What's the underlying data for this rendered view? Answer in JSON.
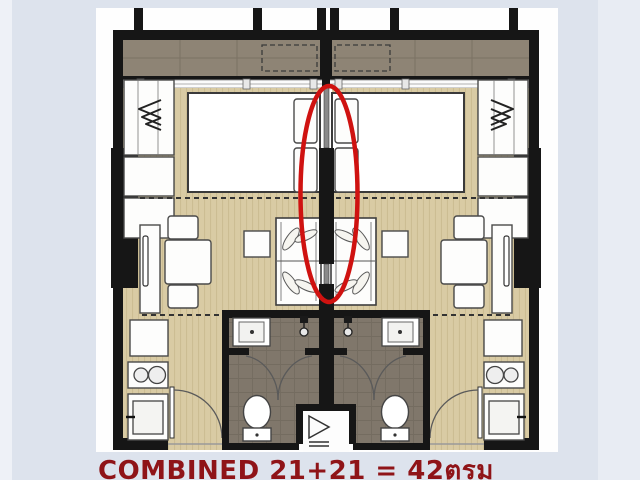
{
  "page": {
    "type": "real-estate floor plan photo",
    "width": 640,
    "height": 480
  },
  "caption": {
    "text": "COMBINED 21+21 = 42ตรม",
    "label": "COMBINED",
    "area_left": "21",
    "area_right": "21",
    "area_total": "42",
    "area_unit": "ตรม"
  },
  "annotation": {
    "shape": "red-ellipse",
    "highlights": "central shared wall between the two mirrored units"
  },
  "floor_plan": {
    "layout": "two mirrored studio units sharing a central dividing wall",
    "units": [
      {
        "id": "left-unit",
        "mirrored": false,
        "elements": [
          "balcony",
          "ac-unit-dashed",
          "sliding-window",
          "wardrobe",
          "storage-cabinets",
          "double-bed",
          "pillows",
          "tv-console",
          "dining-table",
          "dining-chairs",
          "side-table",
          "sofa",
          "kitchen-fridge",
          "kitchen-stove",
          "kitchen-sink",
          "entry-door",
          "bathroom",
          "bathroom-sink",
          "shower",
          "bathroom-doors",
          "toilet"
        ]
      },
      {
        "id": "right-unit",
        "mirrored": true,
        "elements": [
          "balcony",
          "ac-unit-dashed",
          "sliding-window",
          "wardrobe",
          "storage-cabinets",
          "double-bed",
          "pillows",
          "tv-console",
          "dining-table",
          "dining-chairs",
          "side-table",
          "sofa",
          "kitchen-fridge",
          "kitchen-stove",
          "kitchen-sink",
          "entry-door",
          "bathroom",
          "bathroom-sink",
          "shower",
          "bathroom-doors",
          "toilet"
        ]
      }
    ],
    "shared_elements": [
      "central-dividing-wall",
      "balcony-divider",
      "service-shaft"
    ]
  },
  "colors": {
    "background": "#dde3ed",
    "background_light_left": "#eef1f7",
    "background_light_right": "#e8ecf3",
    "plan_white": "#fefefe",
    "wall": "#161616",
    "balcony_floor": "#8e8475",
    "wood_floor": "#d9cba4",
    "wood_stripe": "#ccbd93",
    "bath_floor": "#80776b",
    "annotation_red": "#cf1210",
    "caption_red": "#8f1418"
  }
}
